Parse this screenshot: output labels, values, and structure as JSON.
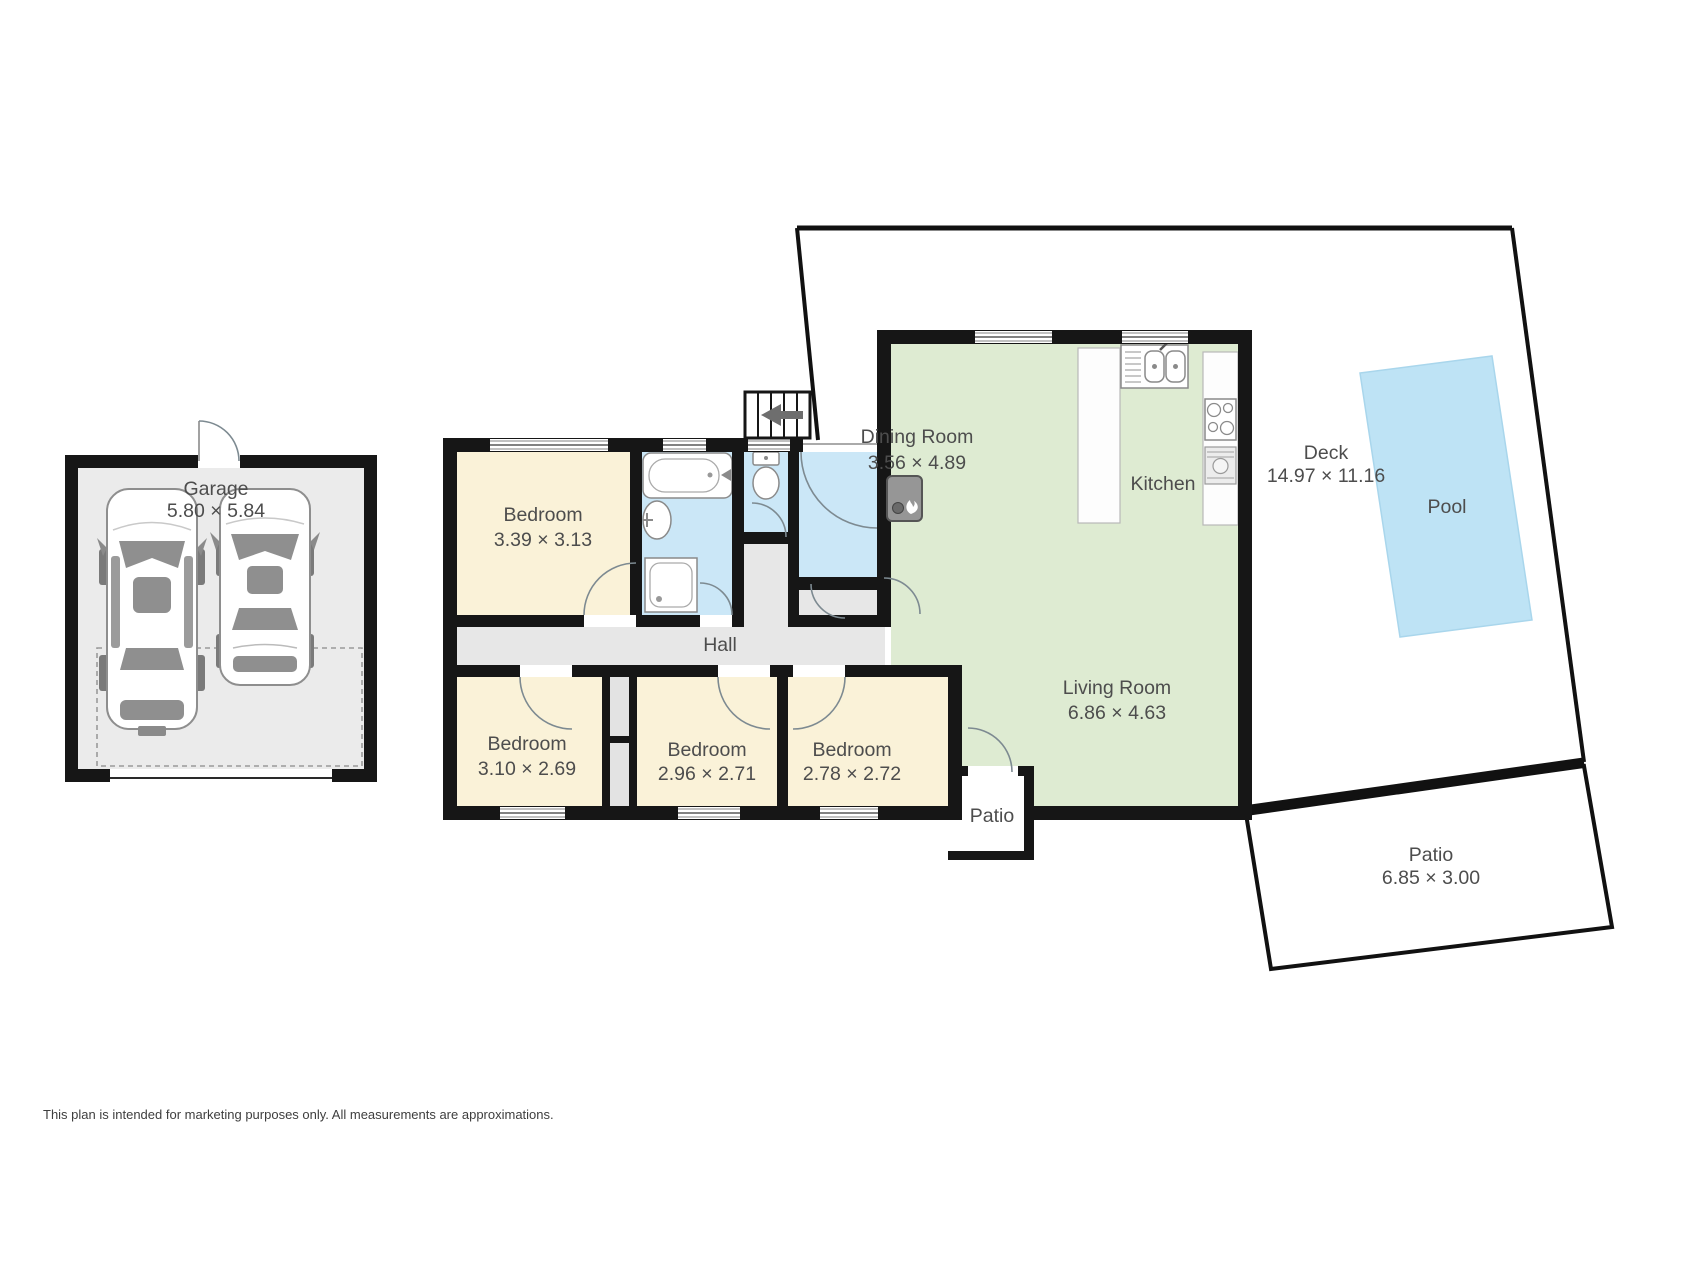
{
  "colors": {
    "wall": "#161616",
    "bedroom": "#FAF2D8",
    "wet": "#CBE7F7",
    "living": "#DEEBD2",
    "hall": "#E7E7E7",
    "closet": "#E3E3E3",
    "garage": "#EBEBEB",
    "pool": "#BEE3F5",
    "label": "#4D4D4D"
  },
  "garage": {
    "label": "Garage",
    "dims": "5.80 × 5.84"
  },
  "rooms": {
    "bedroom_top": {
      "label": "Bedroom",
      "dims": "3.39 × 3.13"
    },
    "bedroom_left": {
      "label": "Bedroom",
      "dims": "3.10 × 2.69"
    },
    "bedroom_mid": {
      "label": "Bedroom",
      "dims": "2.96 × 2.71"
    },
    "bedroom_right": {
      "label": "Bedroom",
      "dims": "2.78 × 2.72"
    },
    "dining": {
      "label": "Dining Room",
      "dims": "3.56 × 4.89"
    },
    "kitchen": {
      "label": "Kitchen"
    },
    "living": {
      "label": "Living Room",
      "dims": "6.86 × 4.63"
    },
    "hall": {
      "label": "Hall"
    },
    "deck": {
      "label": "Deck",
      "dims": "14.97 × 11.16"
    },
    "pool": {
      "label": "Pool"
    },
    "patio_door": {
      "label": "Patio"
    },
    "patio_rear": {
      "label": "Patio",
      "dims": "6.85 × 3.00"
    }
  },
  "footer": {
    "disclaimer": "This plan is intended for marketing purposes only. All measurements are approximations."
  }
}
